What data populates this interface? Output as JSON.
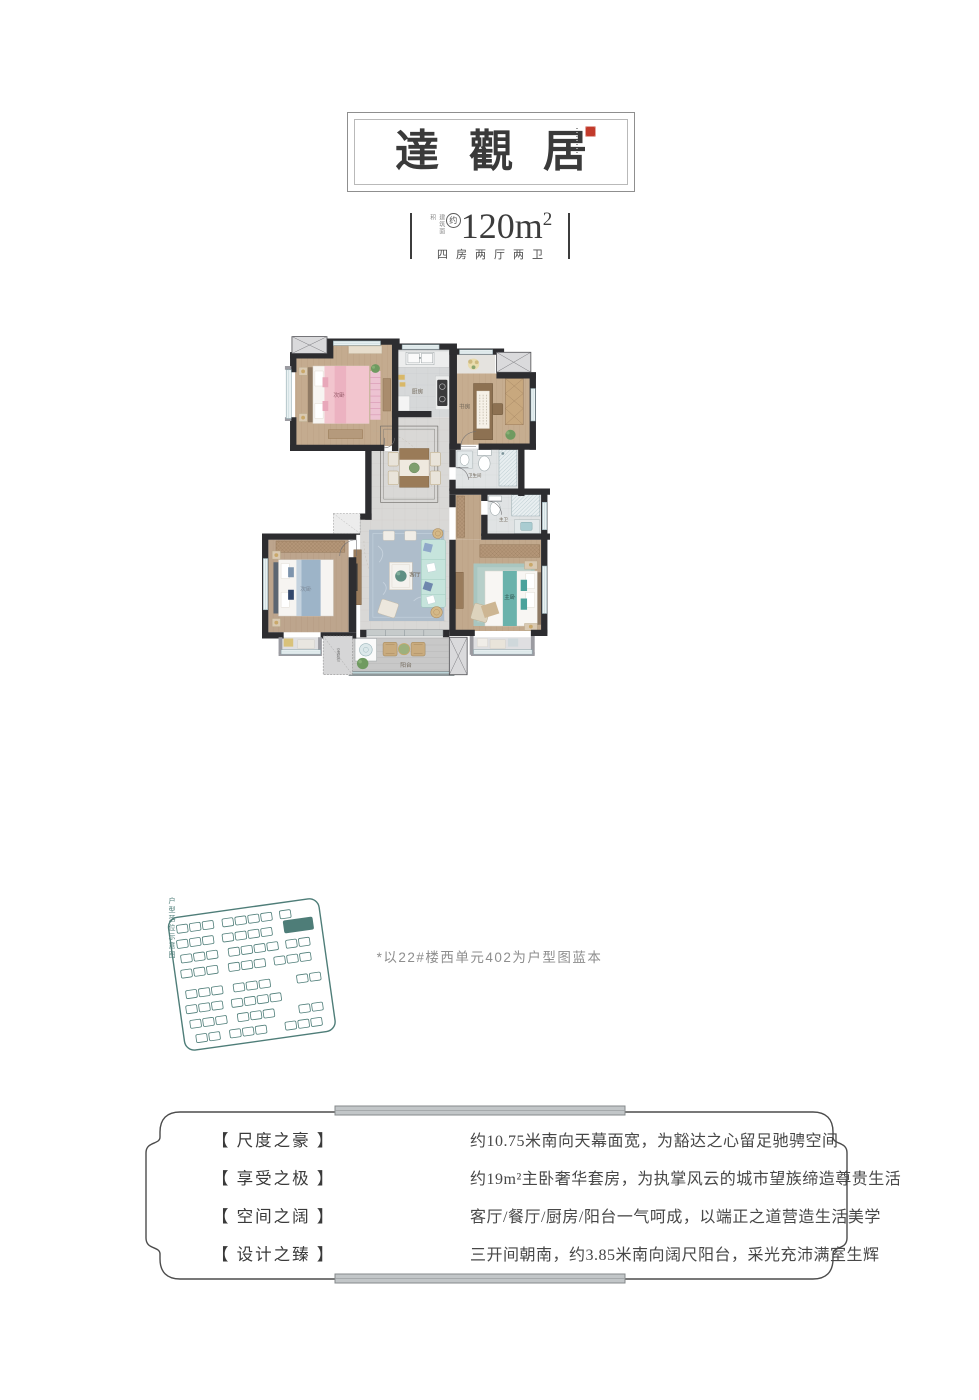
{
  "header": {
    "title": "達觀居",
    "seal_color": "#c23a2b"
  },
  "area": {
    "micro_label": "建筑面积",
    "approx_badge": "约",
    "value": "120m",
    "sup": "2",
    "rooms_line": "四房两厅两卫"
  },
  "plan": {
    "labels": {
      "bedroom_a": "次卧",
      "kitchen": "厨房",
      "study": "书房",
      "bath": "卫生间",
      "master_bath": "主卫",
      "bedroom_b": "次卧",
      "living": "客厅",
      "master": "主卧",
      "balcony": "阳台",
      "ac_unit": "空调机位"
    }
  },
  "siteplan": {
    "caption": "户型落位示意图",
    "accent": "#4e7d78"
  },
  "footnote": "*以22#楼西单元402为户型图蓝本",
  "features": [
    {
      "tag": "【 尺度之豪 】",
      "desc": "约10.75米南向天幕面宽，为豁达之心留足驰骋空间"
    },
    {
      "tag": "【 享受之极 】",
      "desc": "约19m²主卧奢华套房，为执掌风云的城市望族缔造尊贵生活"
    },
    {
      "tag": "【 空间之阔 】",
      "desc": "客厅/餐厅/厨房/阳台一气呵成，以端正之道营造生活美学"
    },
    {
      "tag": "【 设计之臻 】",
      "desc": "三开间朝南，约3.85米南向阔尺阳台，采光充沛满室生辉"
    }
  ]
}
